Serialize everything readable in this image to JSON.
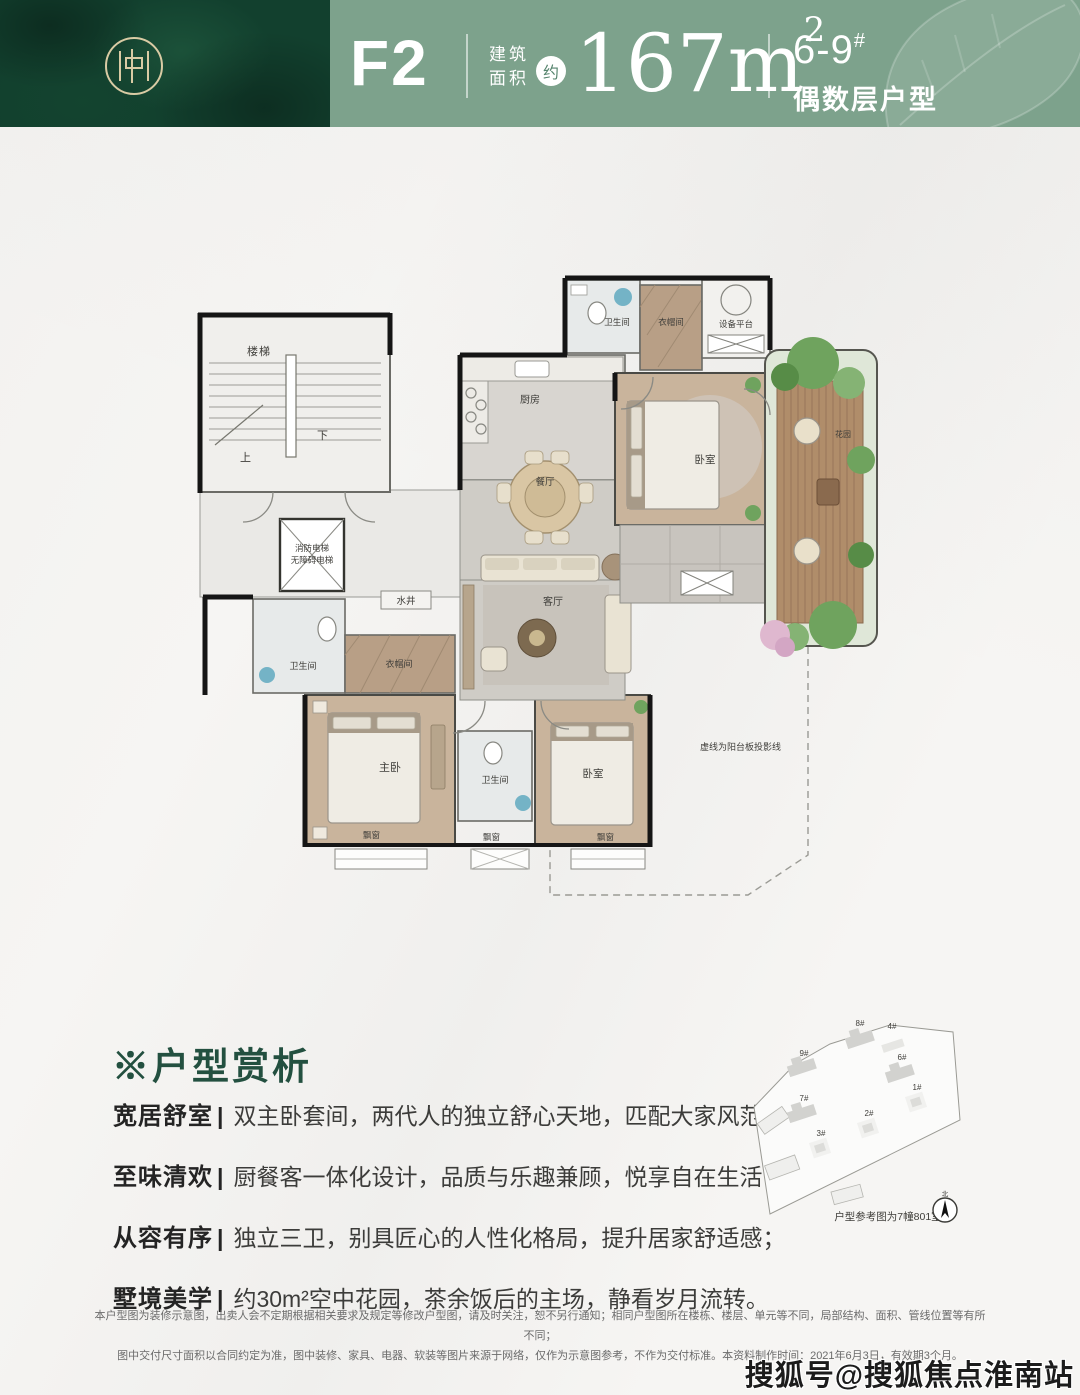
{
  "header": {
    "unit_code": "F2",
    "area_label_top": "建筑",
    "area_label_bottom": "面积",
    "approx_badge": "约",
    "area_value": "167m",
    "area_exponent": "2",
    "building_range": "6-9",
    "building_hash": "#",
    "floor_note": "偶数层户型",
    "colors": {
      "panel_dark_green": "#12402E",
      "bar_sage_green": "#7DA28C",
      "logo_gold": "#D9CBA4",
      "text": "#FFFFFF"
    }
  },
  "floorplan": {
    "labels": {
      "stairs": "楼梯",
      "up": "上",
      "down": "下",
      "elevator_line1": "消防电梯",
      "elevator_line2": "无障碍电梯",
      "water_shaft": "水井",
      "bath_left": "卫生间",
      "cloak_left": "衣帽间",
      "master_bedroom": "主卧",
      "bath_middle": "卫生间",
      "bedroom_south": "卧室",
      "bay_window_1": "飘窗",
      "bay_window_2": "飘窗",
      "bay_window_3": "飘窗",
      "kitchen": "厨房",
      "dining": "餐厅",
      "living": "客厅",
      "bath_top": "卫生间",
      "cloak_top": "衣帽间",
      "equipment_platform": "设备平台",
      "bedroom_north": "卧室",
      "sky_garden": "花园",
      "projection_note": "虚线为阳台板投影线"
    }
  },
  "analysis": {
    "title": "※户型赏析",
    "separator": "|",
    "title_color": "#235040",
    "items": [
      {
        "label": "宽居舒室",
        "text": "双主卧套间，两代人的独立舒心天地，匹配大家风范；"
      },
      {
        "label": "至味清欢",
        "text": "厨餐客一体化设计，品质与乐趣兼顾，悦享自在生活；"
      },
      {
        "label": "从容有序",
        "text": "独立三卫，别具匠心的人性化格局，提升居家舒适感；"
      },
      {
        "label": "墅境美学",
        "text": "约30m²空中花园，茶余饭后的主场，静看岁月流转。"
      }
    ]
  },
  "siteplan": {
    "buildings": [
      "8#",
      "4#",
      "9#",
      "6#",
      "7#",
      "1#",
      "2#",
      "3#"
    ],
    "caption": "户型参考图为7幢801室",
    "compass_label": "北"
  },
  "disclaimer": {
    "line1": "本户型图为装修示意图，出卖人会不定期根据相关要求及规定等修改户型图，请及时关注，恕不另行通知；相同户型图所在楼栋、楼层、单元等不同，局部结构、面积、管线位置等有所不同；",
    "line2": "图中交付尺寸面积以合同约定为准，图中装修、家具、电器、软装等图片来源于网络，仅作为示意图参考，不作为交付标准。本资料制作时间：2021年6月3日，有效期3个月。"
  },
  "watermark": "搜狐号@搜狐焦点淮南站"
}
